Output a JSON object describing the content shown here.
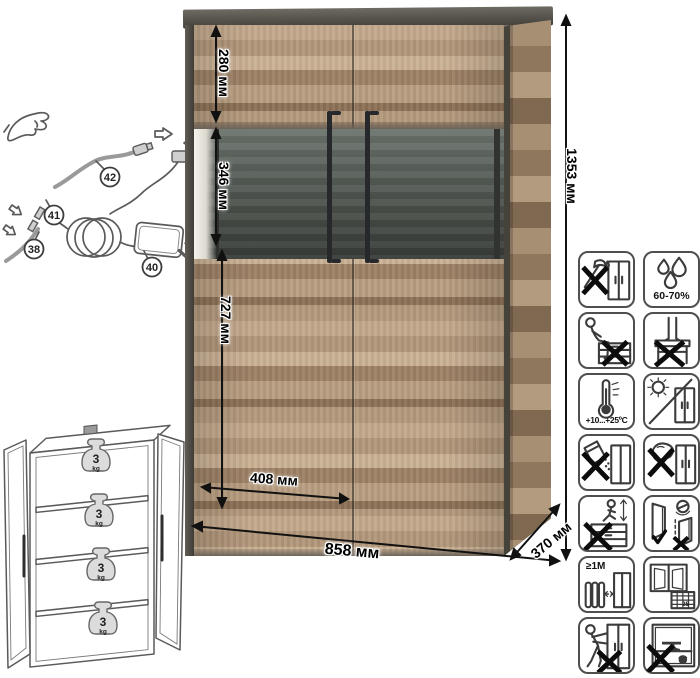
{
  "product": {
    "type": "display-cabinet-with-led"
  },
  "dimensions": {
    "top_section_height": "280 мм",
    "display_section_height": "346 мм",
    "bottom_section_height": "727 мм",
    "door_width": "408 мм",
    "overall_width": "858 мм",
    "depth": "370 мм",
    "overall_height": "1353 мм"
  },
  "wiring": {
    "callouts": [
      {
        "number": "38",
        "part": "led-strip-cable"
      },
      {
        "number": "40",
        "part": "power-adapter"
      },
      {
        "number": "41",
        "part": "inline-connector"
      },
      {
        "number": "42",
        "part": "cable-with-plug"
      }
    ]
  },
  "shelf_load": {
    "value": "3",
    "unit": "kg",
    "shelves": 4
  },
  "care_icons": [
    {
      "name": "no-sharp-tools-icon",
      "label": ""
    },
    {
      "name": "humidity-icon",
      "label": "60-70%"
    },
    {
      "name": "no-sitting-icon",
      "label": ""
    },
    {
      "name": "no-standing-icon",
      "label": ""
    },
    {
      "name": "temperature-range-icon",
      "label": "+10...+25ºC"
    },
    {
      "name": "no-direct-sunlight-icon",
      "label": ""
    },
    {
      "name": "no-abrasive-powder-icon",
      "label": ""
    },
    {
      "name": "no-wet-sponge-icon",
      "label": ""
    },
    {
      "name": "no-climbing-icon",
      "label": ""
    },
    {
      "name": "door-adjustment-icon",
      "label": ""
    },
    {
      "name": "heat-source-distance-icon",
      "label": "≥1M"
    },
    {
      "name": "ventilation-icon",
      "label": "25"
    },
    {
      "name": "no-dragging-icon",
      "label": ""
    },
    {
      "name": "no-overload-icon",
      "label": ""
    }
  ],
  "colors": {
    "wood": "#b2977a",
    "frame_dark": "#53504a",
    "glass_back": "#4a4f4a",
    "handle": "#26282b",
    "dimension_line": "#111111"
  }
}
